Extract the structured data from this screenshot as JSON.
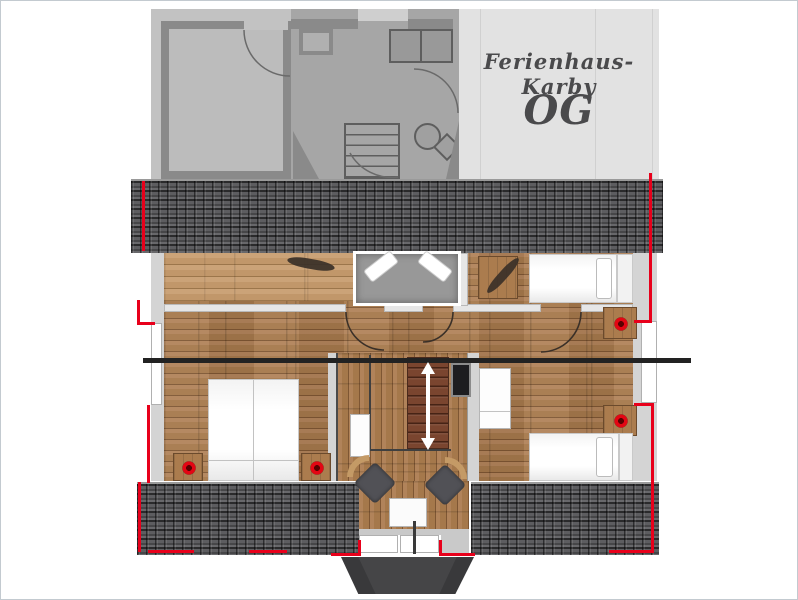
{
  "title_panel": {
    "house_name": "Ferienhaus-Karby",
    "floor_label": "OG"
  },
  "stairs": {
    "direction_arrow": "double-headed-vertical"
  },
  "colors": {
    "page_bg": "#ffffff",
    "page_border": "#c3cad0",
    "ghost_bg": "#c2c2c2",
    "ghost_zone": "#a6a6a6",
    "ghost_wall": "#8a8a8a",
    "ghost_room": "#bcbcbc",
    "ghost_line": "#5e5e5e",
    "title_panel_bg": "#e2e2e2",
    "title_text": "#4a4a4c",
    "panel_line": "#d0d0d0",
    "roof_base": "#5d5d60",
    "wood_base": "#a87a4e",
    "wood_light_c": "#c49c6e",
    "wall_light": "#d4d4d4",
    "inner_wall": "#e6e6e6",
    "inner_wall_edge": "#b9b9b9",
    "red_marking": "#e8001b",
    "accent_dot": "#e30613",
    "bed_gray": "#989898",
    "stair_tread": "#7a452f",
    "chair_dark": "#515156",
    "chair_back": "#c49a66",
    "dormer_roof": "#39393b",
    "section_line": "#222222",
    "tv_black": "#1d1d20"
  },
  "legend": {
    "upper_floor_items": [
      "gray-double-bed",
      "single-bed-top-right",
      "double-bed-bottom-left",
      "single-bed-bottom-right",
      "nightstands-with-red-lamps",
      "plant-decor",
      "staircase-with-arrow",
      "tv-panel",
      "armchairs",
      "side-table",
      "dresser",
      "wardrobe",
      "dormer-with-windows",
      "roof-tiles",
      "window-red-markings",
      "section-line"
    ],
    "ghost_floor_items": [
      "room-with-door",
      "kitchen-counter",
      "closet",
      "staircase",
      "round-table-with-chair",
      "door-arcs"
    ]
  }
}
